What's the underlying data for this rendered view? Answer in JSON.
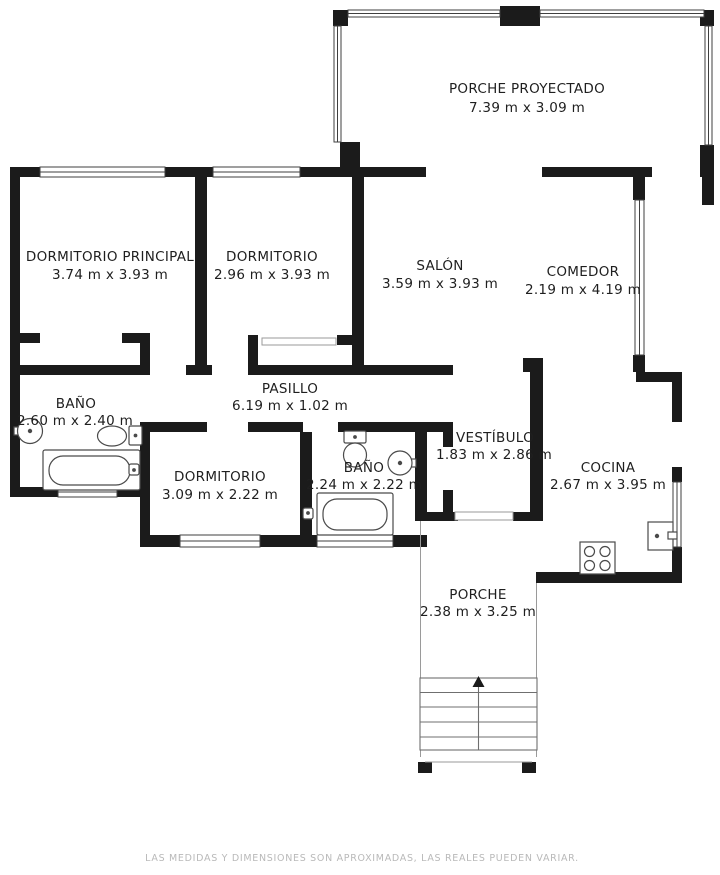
{
  "plan": {
    "title": "floor-plan",
    "rooms": {
      "porche_proyectado": {
        "name": "PORCHE PROYECTADO",
        "dims": "7.39 m x 3.09 m"
      },
      "dormitorio_principal": {
        "name": "DORMITORIO PRINCIPAL",
        "dims": "3.74 m x 3.93 m"
      },
      "dormitorio_2": {
        "name": "DORMITORIO",
        "dims": "2.96 m x 3.93 m"
      },
      "salon": {
        "name": "SALÓN",
        "dims": "3.59 m x 3.93 m"
      },
      "comedor": {
        "name": "COMEDOR",
        "dims": "2.19 m x 4.19 m"
      },
      "bano_1": {
        "name": "BAÑO",
        "dims": "2.60 m x 2.40 m"
      },
      "pasillo": {
        "name": "PASILLO",
        "dims": "6.19 m x 1.02 m"
      },
      "dormitorio_3": {
        "name": "DORMITORIO",
        "dims": "3.09 m x 2.22 m"
      },
      "bano_2": {
        "name": "BAÑO",
        "dims": "2.24 m x 2.22 m"
      },
      "vestibulo": {
        "name": "VESTÍBULO",
        "dims": "1.83 m x 2.86 m"
      },
      "cocina": {
        "name": "COCINA",
        "dims": "2.67 m x 3.95 m"
      },
      "porche": {
        "name": "PORCHE",
        "dims": "2.38 m x 3.25 m"
      }
    },
    "fixtures": [
      "bathtub",
      "bathtub",
      "toilet",
      "toilet",
      "round-sink",
      "round-sink",
      "stove-4-burners",
      "fridge",
      "stairs-up-arrow",
      "windows"
    ],
    "disclaimer": "LAS MEDIDAS Y DIMENSIONES SON APROXIMADAS, LAS REALES PUEDEN VARIAR.",
    "colors": {
      "wall": "#1b1b1b",
      "text": "#1f1f1f",
      "fixture": "#4a4a4a",
      "thin_line": "#9a9a9a",
      "disclaimer": "#b9b9b9",
      "background": "#ffffff"
    }
  }
}
